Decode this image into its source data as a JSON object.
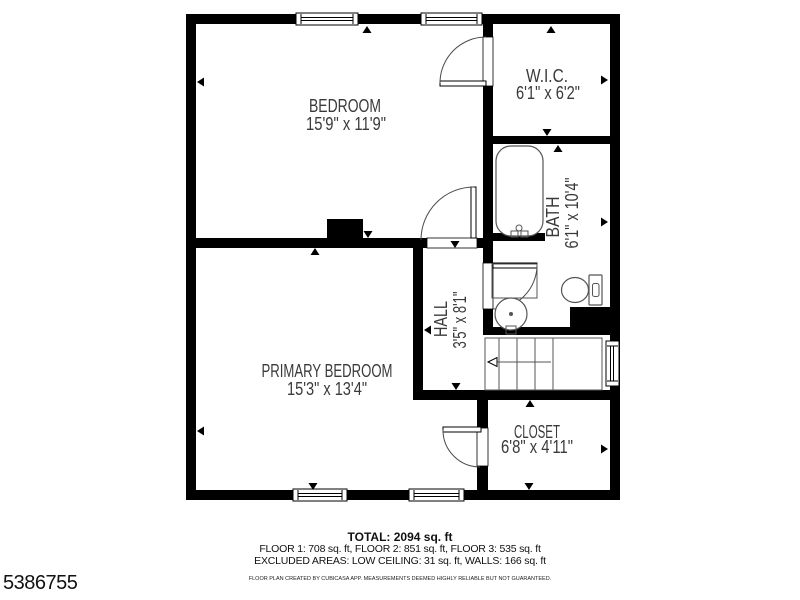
{
  "floorplan": {
    "rooms": [
      {
        "name": "BEDROOM",
        "dims": "15'9\" x 11'9\""
      },
      {
        "name": "W.I.C.",
        "dims": "6'1\" x 6'2\""
      },
      {
        "name": "BATH",
        "dims": "6'1\" x 10'4\""
      },
      {
        "name": "HALL",
        "dims": "3'5\" x 8'1\""
      },
      {
        "name": "PRIMARY BEDROOM",
        "dims": "15'3\" x 13'4\""
      },
      {
        "name": "CLOSET",
        "dims": "6'8\" x 4'11\""
      }
    ],
    "colors": {
      "wall": "#000000",
      "room_text": "#3a3a3a",
      "background": "#ffffff"
    }
  },
  "summary": {
    "total": "TOTAL: 2094 sq. ft",
    "floors": "FLOOR 1: 708 sq. ft, FLOOR 2: 851 sq. ft, FLOOR 3: 535 sq. ft",
    "excluded": "EXCLUDED AREAS: LOW CEILING: 31 sq. ft, WALLS: 166 sq. ft",
    "disclaimer": "FLOOR PLAN CREATED BY CUBICASA APP. MEASUREMENTS DEEMED HIGHLY RELIABLE BUT NOT GUARANTEED."
  },
  "listing_id": "5386755"
}
